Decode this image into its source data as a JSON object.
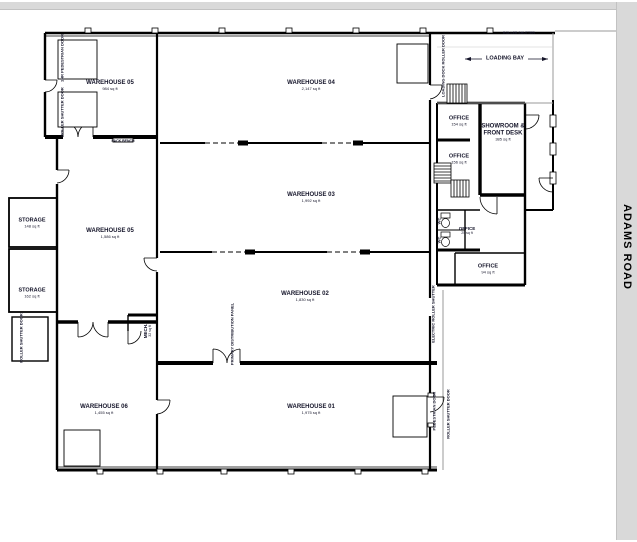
{
  "plan_title": "Warehouse floor plan",
  "roads": {
    "right_label": "ADAMS ROAD"
  },
  "rooms": {
    "warehouse_05_upper": {
      "name": "WAREHOUSE 05",
      "area": "984 sq ft"
    },
    "warehouse_04": {
      "name": "WAREHOUSE 04",
      "area": "2,147 sq ft"
    },
    "warehouse_03": {
      "name": "WAREHOUSE 03",
      "area": "1,992 sq ft"
    },
    "warehouse_05": {
      "name": "WAREHOUSE 05",
      "area": "1,586 sq ft"
    },
    "warehouse_02": {
      "name": "WAREHOUSE 02",
      "area": "1,830 sq ft"
    },
    "warehouse_01": {
      "name": "WAREHOUSE 01",
      "area": "1,975 sq ft"
    },
    "warehouse_06": {
      "name": "WAREHOUSE 06",
      "area": "1,455 sq ft"
    },
    "storage_upper": {
      "name": "STORAGE",
      "area": "148 sq ft"
    },
    "storage_lower": {
      "name": "STORAGE",
      "area": "162 sq ft"
    },
    "office_1": {
      "name": "OFFICE",
      "area": "154 sq ft"
    },
    "office_2": {
      "name": "OFFICE",
      "area": "156 sq ft"
    },
    "office_3": {
      "name": "OFFICE",
      "area": "25 sq ft"
    },
    "office_4": {
      "name": "OFFICE",
      "area": "94 sq ft"
    },
    "showroom": {
      "name": "SHOWROOM & FRONT DESK",
      "area": "385 sq ft"
    },
    "mech": {
      "name": "MECH.",
      "area": "32 sq ft"
    }
  },
  "annotations": {
    "loading_bay": "LOADING BAY",
    "pack_bench": "PACK BENCH",
    "roller_shutter_top": "ROLLER SHUTTER",
    "loading_dock_door": "LOADING DOCK ROLLER DOOR",
    "pedestrian_door_left": "1HR PEDESTRIAN DOOR",
    "roller_door_left": "ROLLER SHUTTER DOOR",
    "roller_door_sw": "ROLLER SHUTTER DOOR",
    "primary_panel": "PRIMARY DISTRIBUTION PANEL",
    "electric_roller_right": "ELECTRIC ROLLER SHUTTER",
    "pedestrian_door_se": "PEDESTRIAN DOOR",
    "roller_door_se": "ROLLER SHUTTER DOOR",
    "wc_1": "WC",
    "wc_2": "WC"
  },
  "colors": {
    "road": "#d9d9d9",
    "wall": "#000000",
    "label_text": "#15152a",
    "apron": "#9a9a9a"
  }
}
